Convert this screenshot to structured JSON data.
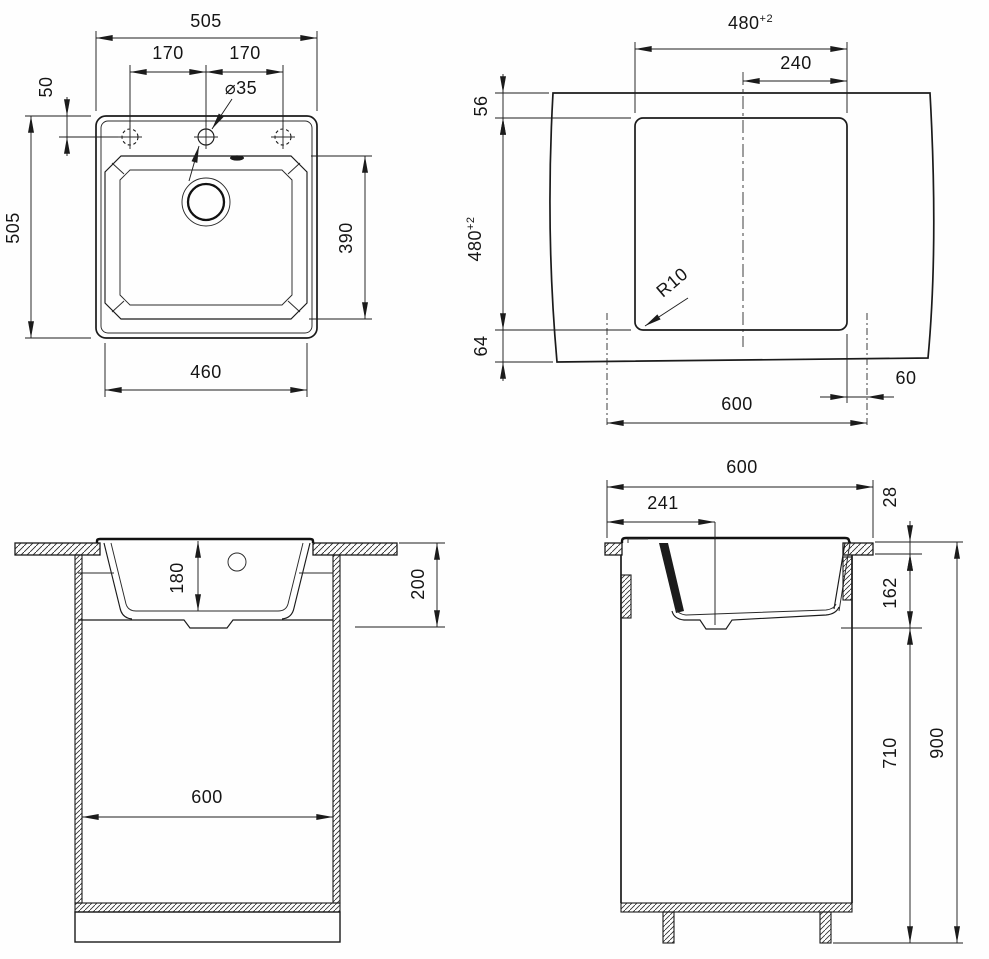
{
  "drawing": {
    "title": "sink-installation-technical-drawing",
    "views": {
      "top_view": {
        "dims": {
          "overall_width": "505",
          "hole_spacing_left": "170",
          "hole_spacing_right": "170",
          "tap_hole_diameter": "⌀35",
          "tap_hole_offset": "50",
          "overall_depth": "505",
          "bowl_depth": "390",
          "bowl_width": "460"
        }
      },
      "cutout_view": {
        "dims": {
          "cutout_width": "480",
          "cutout_width_tolerance": "+2",
          "center_to_edge": "240",
          "front_margin": "56",
          "cutout_depth": "480",
          "cutout_depth_tolerance": "+2",
          "rear_margin": "64",
          "corner_radius": "R10",
          "edge_offset": "60",
          "cabinet_width": "600"
        }
      },
      "front_section": {
        "dims": {
          "bowl_inner_depth": "180",
          "depth_below_top": "200",
          "cabinet_inner_width": "600"
        }
      },
      "side_section": {
        "dims": {
          "countertop_depth": "600",
          "drain_offset": "241",
          "countertop_thickness": "28",
          "sink_below_top": "162",
          "cabinet_body_height": "710",
          "overall_height": "900"
        }
      }
    }
  }
}
